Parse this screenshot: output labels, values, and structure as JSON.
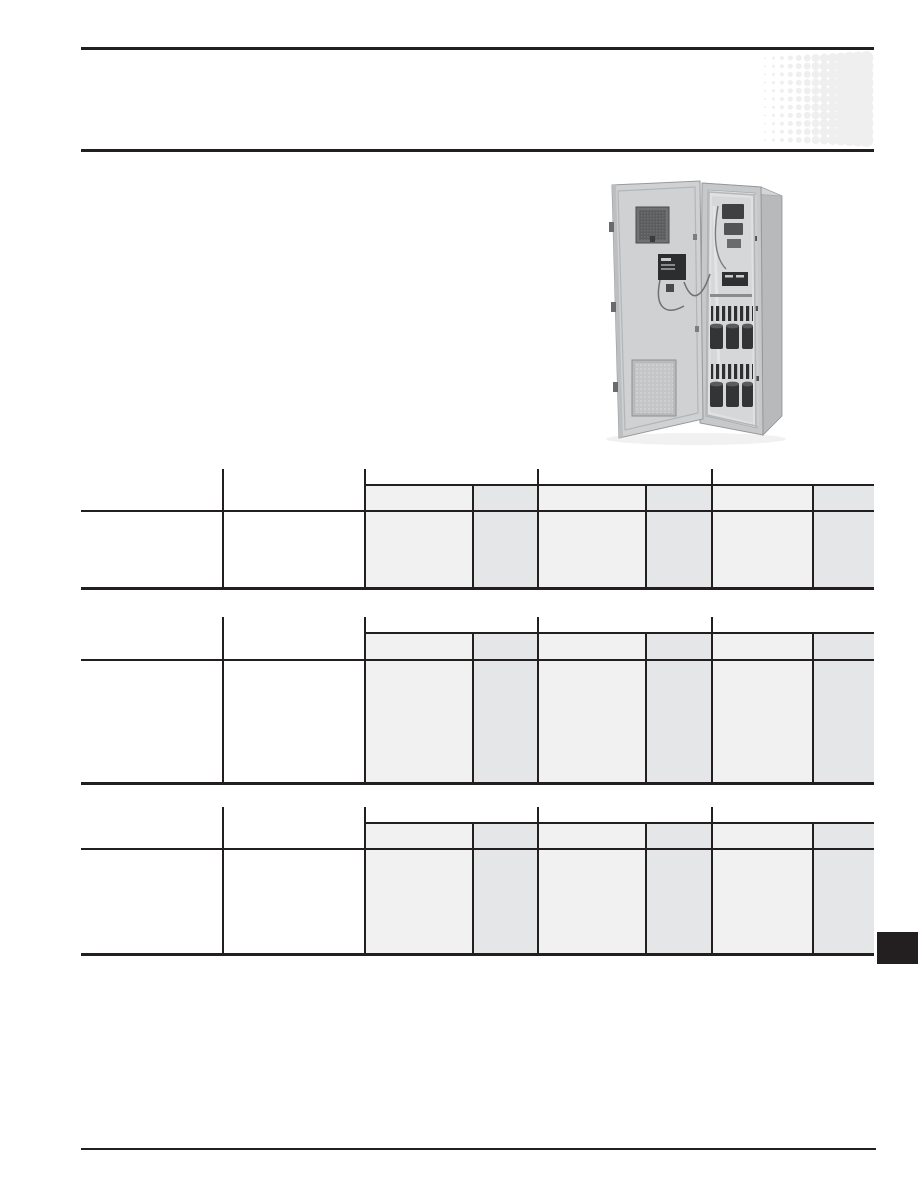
{
  "page": {
    "width": 918,
    "height": 1188,
    "background": "#ffffff"
  },
  "colors": {
    "rule": "#231f20",
    "table_line": "#231f20",
    "light_column_fill": "#f0f1f0",
    "dark_column_fill": "#e4e6e8",
    "halftone_dot": "#efefef",
    "page_tab": "#231f20"
  },
  "header": {
    "top_rule": {
      "x": 81,
      "y": 47,
      "w": 793,
      "h": 3
    },
    "bottom_rule": {
      "x": 81,
      "y": 149,
      "w": 793,
      "h": 3
    },
    "halftone": {
      "x": 755,
      "y": 50,
      "w": 125,
      "h": 100,
      "cols": 13,
      "rows": 11,
      "dx": 8.45,
      "dy": 8.2,
      "cx0": 10,
      "cy0": 8,
      "r0": 1.0,
      "dr": 0.5
    }
  },
  "figure": {
    "description": "electrical-enclosure-cabinet-open-door-photo",
    "x": 596,
    "y": 176,
    "w": 192,
    "h": 272
  },
  "tables": {
    "left": 81,
    "width": 793,
    "full_vlines": [
      141,
      283,
      456,
      630
    ],
    "sub_vlines": [
      391,
      564,
      731
    ],
    "light_columns": [
      [
        283,
        108
      ],
      [
        456,
        108
      ],
      [
        630,
        101
      ]
    ],
    "dark_columns": [
      [
        391,
        65
      ],
      [
        564,
        66
      ],
      [
        731,
        62
      ]
    ],
    "band_line_start": 283,
    "line_w": 1.5,
    "items": [
      {
        "name": "spec-table-1",
        "top": 469,
        "band": 15,
        "header": 41,
        "bottom": 118
      },
      {
        "name": "spec-table-2",
        "top": 617,
        "band": 15,
        "header": 42,
        "bottom": 165
      },
      {
        "name": "spec-table-3",
        "top": 807,
        "band": 15,
        "header": 41,
        "bottom": 146
      }
    ]
  },
  "page_tab": {
    "x": 877,
    "y": 932,
    "w": 41,
    "h": 32
  },
  "footer_rule": {
    "x": 81,
    "y": 1148,
    "w": 795,
    "h": 2
  }
}
